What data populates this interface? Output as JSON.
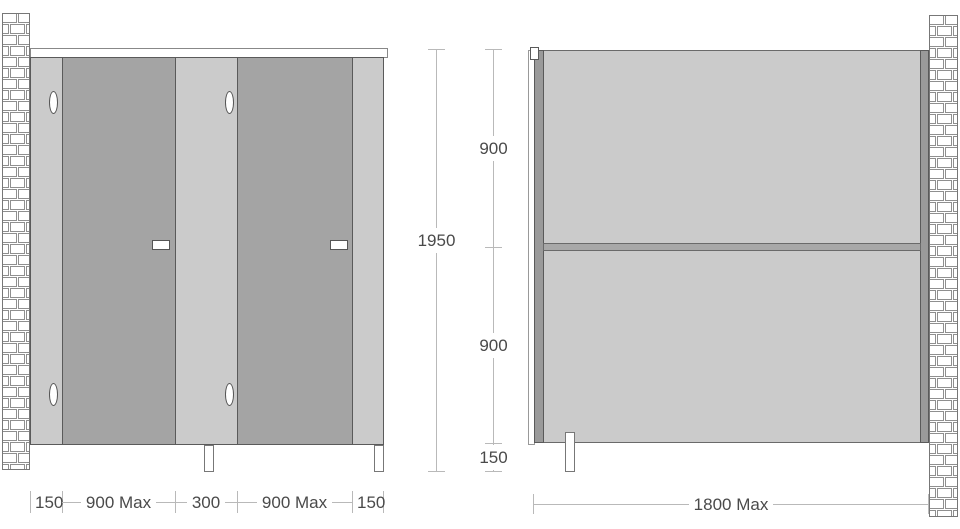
{
  "front_elevation": {
    "width_dimensions": [
      "150",
      "900 Max",
      "300",
      "900 Max",
      "150"
    ],
    "height_dimension": "1950"
  },
  "side_elevation": {
    "height_dimensions": [
      "900",
      "900",
      "150"
    ],
    "width_dimension": "1800 Max"
  },
  "colors": {
    "door_fill": "#a4a4a4",
    "pilaster_fill": "#cbcbcb",
    "panel_fill": "#cbcbcb",
    "post_fill": "#9a9a9a",
    "rail_fill": "#a8a8a8",
    "outline": "#5a5a5a",
    "hardware_outline": "#555555",
    "dim_line": "#b9b9b9",
    "dim_text": "#4a4a4a",
    "brick_line": "#8f8f8f",
    "wall_border": "#777777"
  }
}
